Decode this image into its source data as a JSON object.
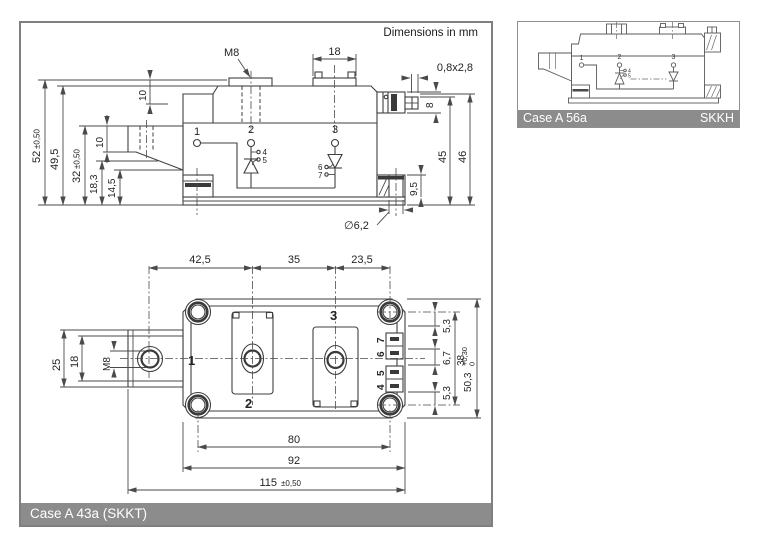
{
  "note": "Dimensions in mm",
  "colors": {
    "line": "#3f3f3f",
    "frame": "#7f7f7f",
    "bar_background": "#8c8c8c",
    "bar_text": "#ffffff"
  },
  "side_view": {
    "m8_label": "M8",
    "dim_18": "18",
    "faston_dim": "0,8x2,8",
    "dim_10_top": "10",
    "dim_8": "8",
    "dim_52": "52",
    "dim_52_tol": "±0,50",
    "dim_49_5": "49,5",
    "dim_32": "32",
    "dim_32_tol": "±0,50",
    "dim_10_mid": "10",
    "dim_18_3": "18,3",
    "dim_14_5": "14,5",
    "dim_45": "45",
    "dim_46": "46",
    "dim_9_5": "9,5",
    "dia_hole": "∅6,2",
    "terminal_1": "1",
    "terminal_2": "2",
    "terminal_3": "3",
    "pin_4": "4",
    "pin_5": "5",
    "pin_6": "6",
    "pin_7": "7"
  },
  "plan_view": {
    "dim_42_5": "42,5",
    "dim_35": "35",
    "dim_23_5": "23,5",
    "dim_25": "25",
    "dim_18": "18",
    "m8_label": "M8",
    "terminal_1": "1",
    "terminal_2": "2",
    "terminal_3": "3",
    "pin_4": "4",
    "pin_5": "5",
    "pin_6": "6",
    "pin_7": "7",
    "dim_5_3_top": "5,3",
    "dim_6_7": "6,7",
    "dim_5_3_bottom": "5,3",
    "dim_38": "38",
    "dim_50_3": "50,3",
    "dim_50_3_tol_plus": "+0,30",
    "dim_50_3_tol_minus": "0",
    "dim_80": "80",
    "dim_92": "92",
    "dim_115": "115",
    "dim_115_tol": "±0,50"
  },
  "footer": {
    "label": "Case A 43a (SKKT)"
  },
  "inset": {
    "case_label": "Case A 56a",
    "series_label": "SKKH",
    "terminal_1": "1",
    "terminal_2": "2",
    "terminal_3": "3",
    "pin_4": "4",
    "pin_5": "5"
  }
}
